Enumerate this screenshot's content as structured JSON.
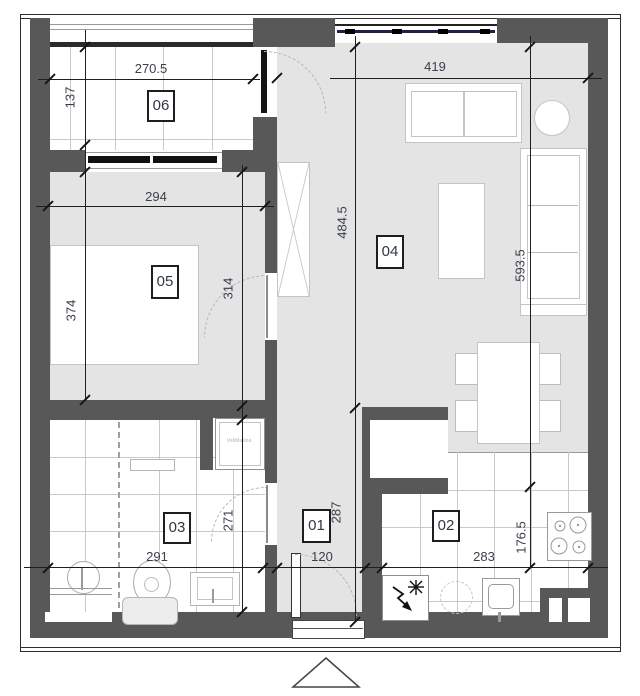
{
  "plan": {
    "type": "apartment-floor-plan",
    "rooms": {
      "r01": {
        "label": "01"
      },
      "r02": {
        "label": "02"
      },
      "r03": {
        "label": "03"
      },
      "r04": {
        "label": "04"
      },
      "r05": {
        "label": "05"
      },
      "r06": {
        "label": "06"
      }
    },
    "dims": {
      "balcony_w": "270.5",
      "balcony_d": "137",
      "bedroom_w": "294",
      "bedroom_h_left": "374",
      "bedroom_h_right": "314",
      "living_w": "419",
      "living_h": "484.5",
      "living_h_right": "593.5",
      "bath_w": "291",
      "bath_h": "271",
      "hall_w": "120",
      "hall_h": "287",
      "kitchen_w": "283",
      "kitchen_h": "176.5"
    },
    "labels": {
      "washing_machine": "VešMašina"
    },
    "icons": {
      "electric": "bolt-star-icon",
      "entrance": "triangle-up-icon"
    },
    "colors": {
      "wall": "#585858",
      "floor": "#e4e4e4",
      "dim_text": "#39404d",
      "window_glazing": "#1d2147"
    }
  }
}
